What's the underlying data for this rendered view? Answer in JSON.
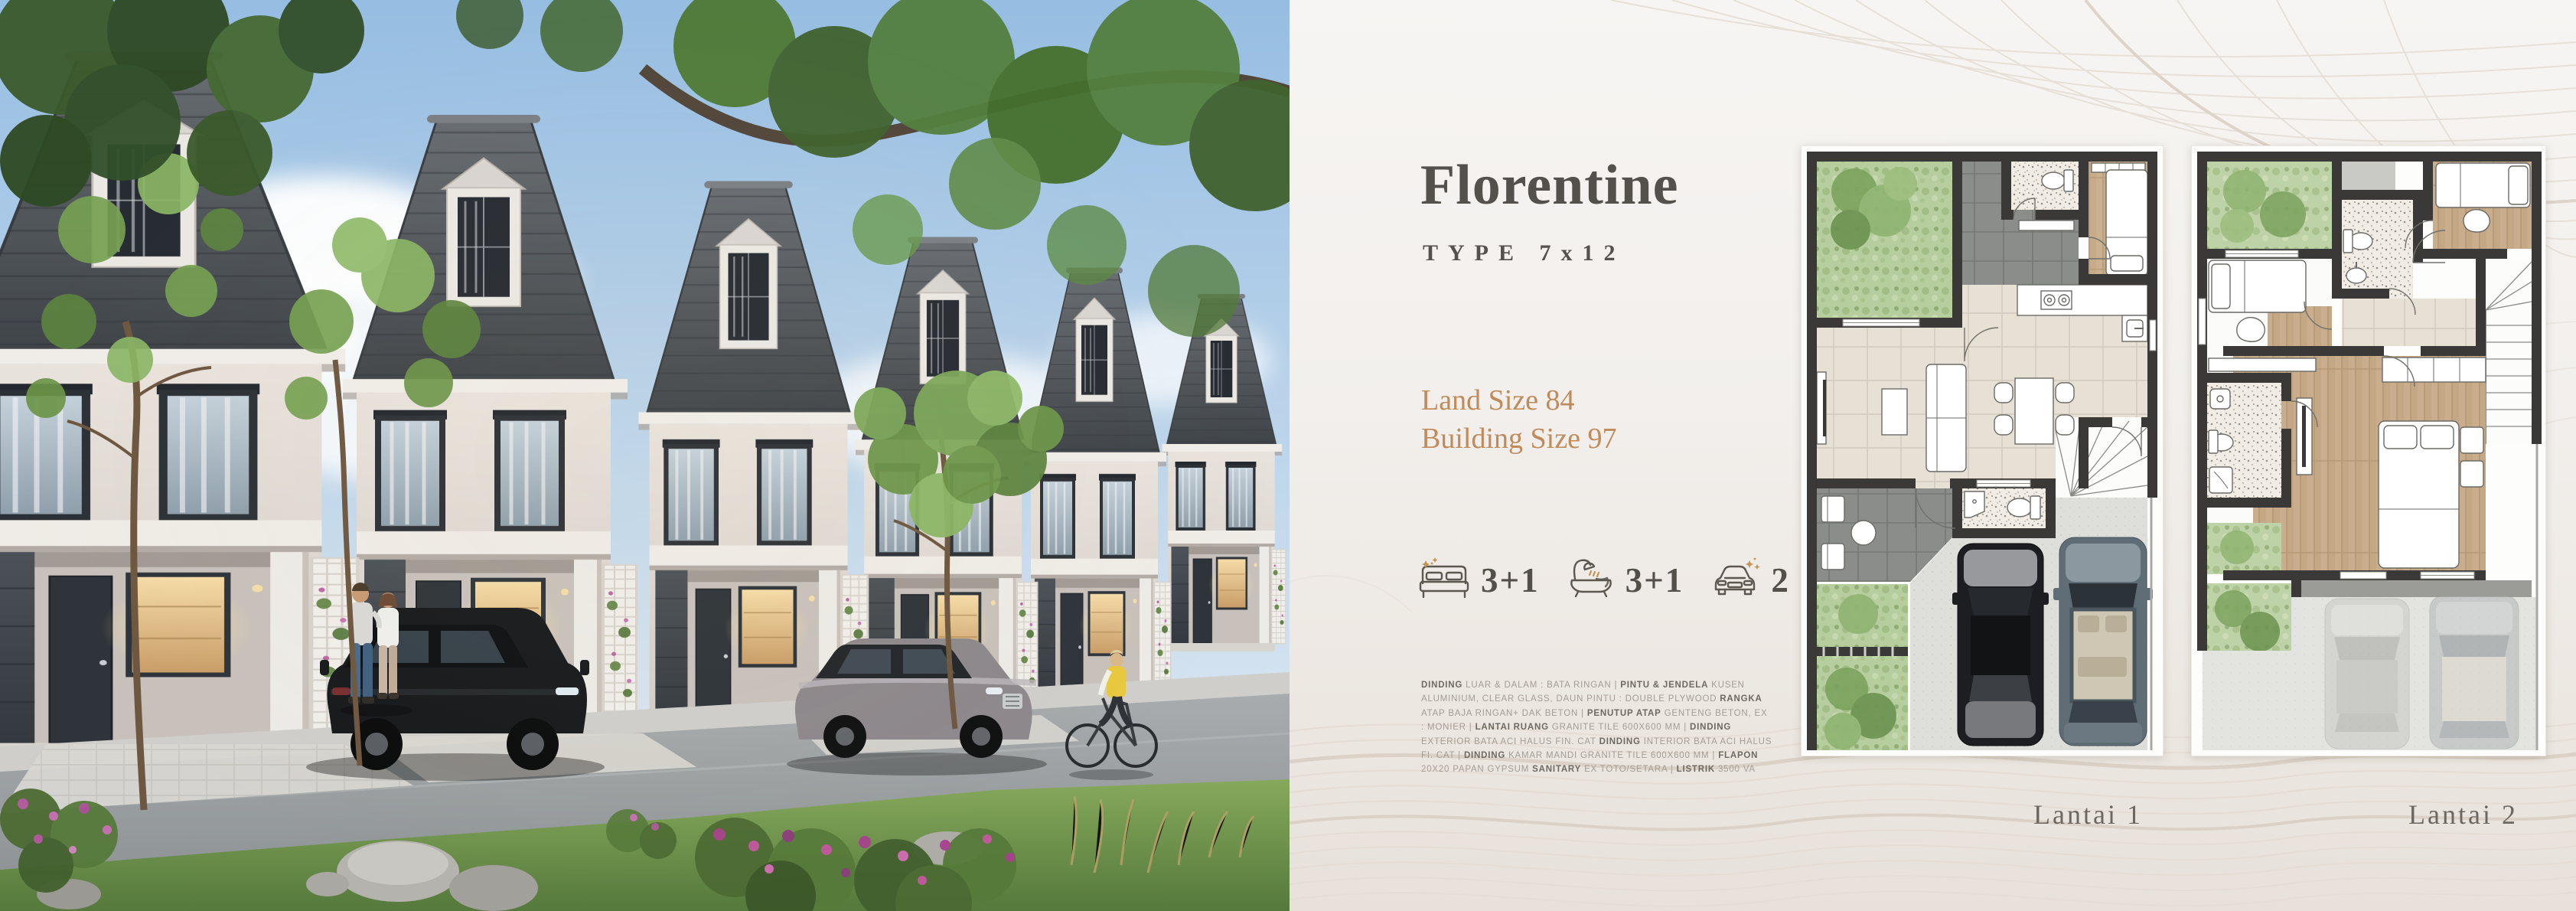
{
  "info": {
    "title": "Florentine",
    "type": "TYPE 7x12",
    "land_size": "Land Size 84",
    "building_size": "Building Size 97"
  },
  "stats": [
    {
      "icon": "bed-icon",
      "value": "3+1"
    },
    {
      "icon": "bath-icon",
      "value": "3+1"
    },
    {
      "icon": "car-icon",
      "value": "2"
    }
  ],
  "specs": {
    "segments": [
      {
        "text": "DINDING",
        "bold": true
      },
      {
        "text": " LUAR & DALAM : BATA RINGAN | ",
        "bold": false
      },
      {
        "text": "PINTU & JENDELA",
        "bold": true
      },
      {
        "text": " KUSEN ALUMINIUM, CLEAR GLASS, DAUN PINTU : DOUBLE PLYWOOD ",
        "bold": false
      },
      {
        "text": "RANGKA",
        "bold": true
      },
      {
        "text": " ATAP BAJA RINGAN+ DAK BETON | ",
        "bold": false
      },
      {
        "text": "PENUTUP ATAP",
        "bold": true
      },
      {
        "text": " GENTENG BETON, EX : MONIER | ",
        "bold": false
      },
      {
        "text": "LANTAI RUANG",
        "bold": true
      },
      {
        "text": " GRANITE TILE 600X600 MM | ",
        "bold": false
      },
      {
        "text": "DINDING",
        "bold": true
      },
      {
        "text": " EXTERIOR BATA ACI HALUS FIN. CAT ",
        "bold": false
      },
      {
        "text": "DINDING",
        "bold": true
      },
      {
        "text": " INTERIOR BATA ACI HALUS FI. CAT | ",
        "bold": false
      },
      {
        "text": "DINDING",
        "bold": true
      },
      {
        "text": " KAMAR MANDI GRANITE TILE 600X600 MM | ",
        "bold": false
      },
      {
        "text": "FLAPON",
        "bold": true
      },
      {
        "text": " 20X20 PAPAN GYPSUM ",
        "bold": false
      },
      {
        "text": "SANITARY",
        "bold": true
      },
      {
        "text": " EX TOTO/SETARA | ",
        "bold": false
      },
      {
        "text": "LISTRIK",
        "bold": true
      },
      {
        "text": " 3500 VA",
        "bold": false
      }
    ]
  },
  "floorplans": [
    {
      "label": "Lantai 1"
    },
    {
      "label": "Lantai 2"
    }
  ],
  "colors": {
    "accent_gold": "#bf8b5a",
    "heading": "#54504b",
    "spec_text": "#a39d94",
    "spec_bold": "#6e6a62",
    "panel_bg": "#f2efec",
    "contour_line": "#e6ded6",
    "icon_stroke": "#5c5850",
    "icon_sparkle": "#c49455"
  }
}
